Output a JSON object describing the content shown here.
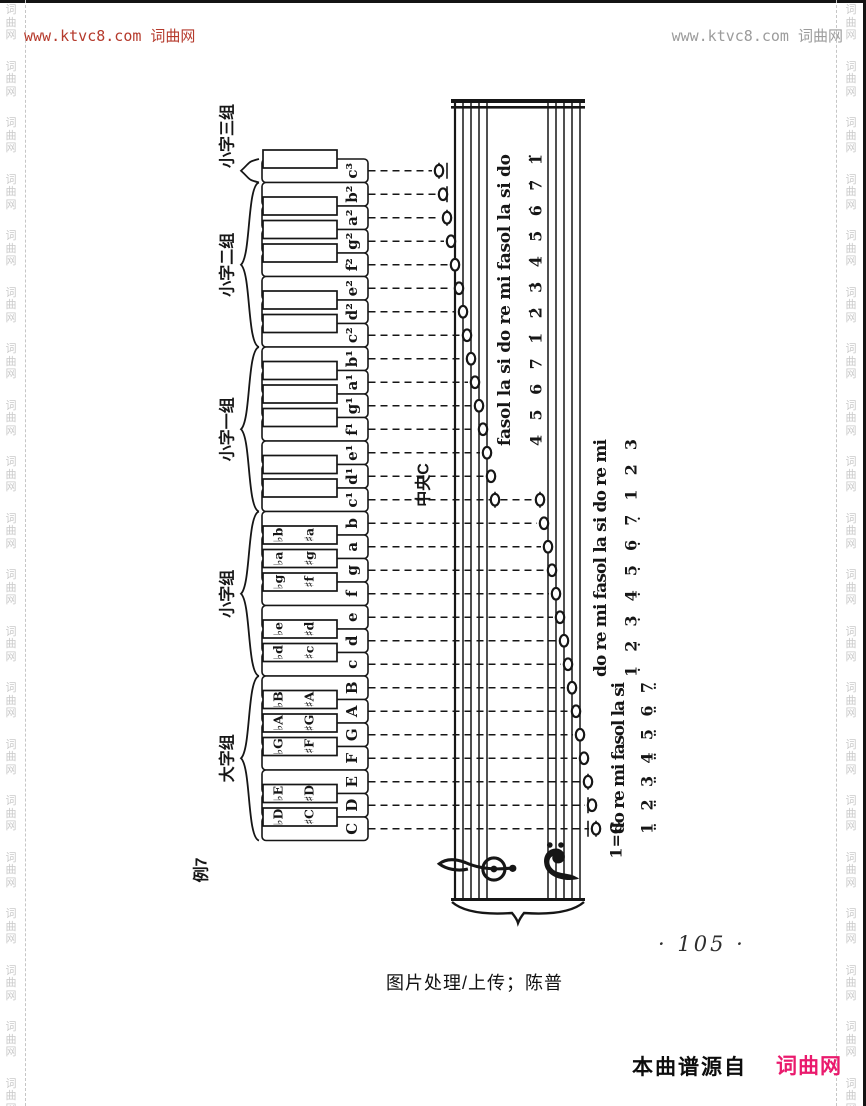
{
  "page": {
    "header_left": "www.ktvc8.com 词曲网",
    "header_right": "www.ktvc8.com 词曲网",
    "page_number": "· 105 ·",
    "credit": "图片处理/上传；陈普",
    "footer_source": "本曲谱源自",
    "footer_brand": "词曲网",
    "watermark": {
      "chars": "词曲网",
      "repeats": 20
    },
    "colors": {
      "header_left": "#b53a2c",
      "header_right": "#9c9c9c",
      "brand": "#ea1a6d",
      "watermark": "#c9c9c9",
      "ink": "#161616"
    }
  },
  "keyboard": {
    "example_label": "例7",
    "middle_c_label": "中央C",
    "white_keys": [
      "c³",
      "b²",
      "a²",
      "g²",
      "f²",
      "e²",
      "d²",
      "c²",
      "b¹",
      "a¹",
      "g¹",
      "f¹",
      "e¹",
      "d¹",
      "c¹",
      "b",
      "a",
      "g",
      "f",
      "e",
      "d",
      "c",
      "B",
      "A",
      "G",
      "F",
      "E",
      "D",
      "C"
    ],
    "black_keys": [
      {
        "after": -1
      },
      {
        "after": 1
      },
      {
        "after": 2
      },
      {
        "after": 3
      },
      {
        "after": 5
      },
      {
        "after": 6
      },
      {
        "after": 8
      },
      {
        "after": 9
      },
      {
        "after": 10
      },
      {
        "after": 12
      },
      {
        "after": 13
      },
      {
        "after": 15,
        "flat": "♭b",
        "sharp": "♯a"
      },
      {
        "after": 16,
        "flat": "♭a",
        "sharp": "♯g"
      },
      {
        "after": 17,
        "flat": "♭g",
        "sharp": "♯f"
      },
      {
        "after": 19,
        "flat": "♭e",
        "sharp": "♯d"
      },
      {
        "after": 20,
        "flat": "♭d",
        "sharp": "♯c"
      },
      {
        "after": 22,
        "flat": "♭B",
        "sharp": "♯A"
      },
      {
        "after": 23,
        "flat": "♭A",
        "sharp": "♯G"
      },
      {
        "after": 24,
        "flat": "♭G",
        "sharp": "♯F"
      },
      {
        "after": 26,
        "flat": "♭E",
        "sharp": "♯D"
      },
      {
        "after": 27,
        "flat": "♭D",
        "sharp": "♯C"
      }
    ],
    "groups": [
      {
        "label": "小字三组",
        "from": 0,
        "to": 0
      },
      {
        "label": "小字二组",
        "from": 1,
        "to": 7
      },
      {
        "label": "小字一组",
        "from": 8,
        "to": 14
      },
      {
        "label": "小字组",
        "from": 15,
        "to": 21
      },
      {
        "label": "大字组",
        "from": 22,
        "to": 28
      }
    ]
  },
  "staff": {
    "clefs": [
      "treble-clef",
      "bass-clef"
    ],
    "solfege_columns": [
      {
        "name": "treble",
        "syllables": "fasol la si do re mi fasol la si do",
        "numbers": "4 5 6 7 1̇ 2̇ 3̇ 4̇ 5̇ 6̇ 7̇ 1̈"
      },
      {
        "name": "middle",
        "syllables": "do re mi fasol la si do re mi",
        "numbers": "1̣ 2̣ 3̣ 4̣ 5̣ 6̣ 7̣ 1 2 3"
      },
      {
        "name": "bass",
        "syllables": "do re mi fasol la si",
        "numbers": "1̤ 2̤ 3̤ 4̤ 5̤ 6̤ 7̤"
      }
    ],
    "key_signature": "1=C"
  }
}
